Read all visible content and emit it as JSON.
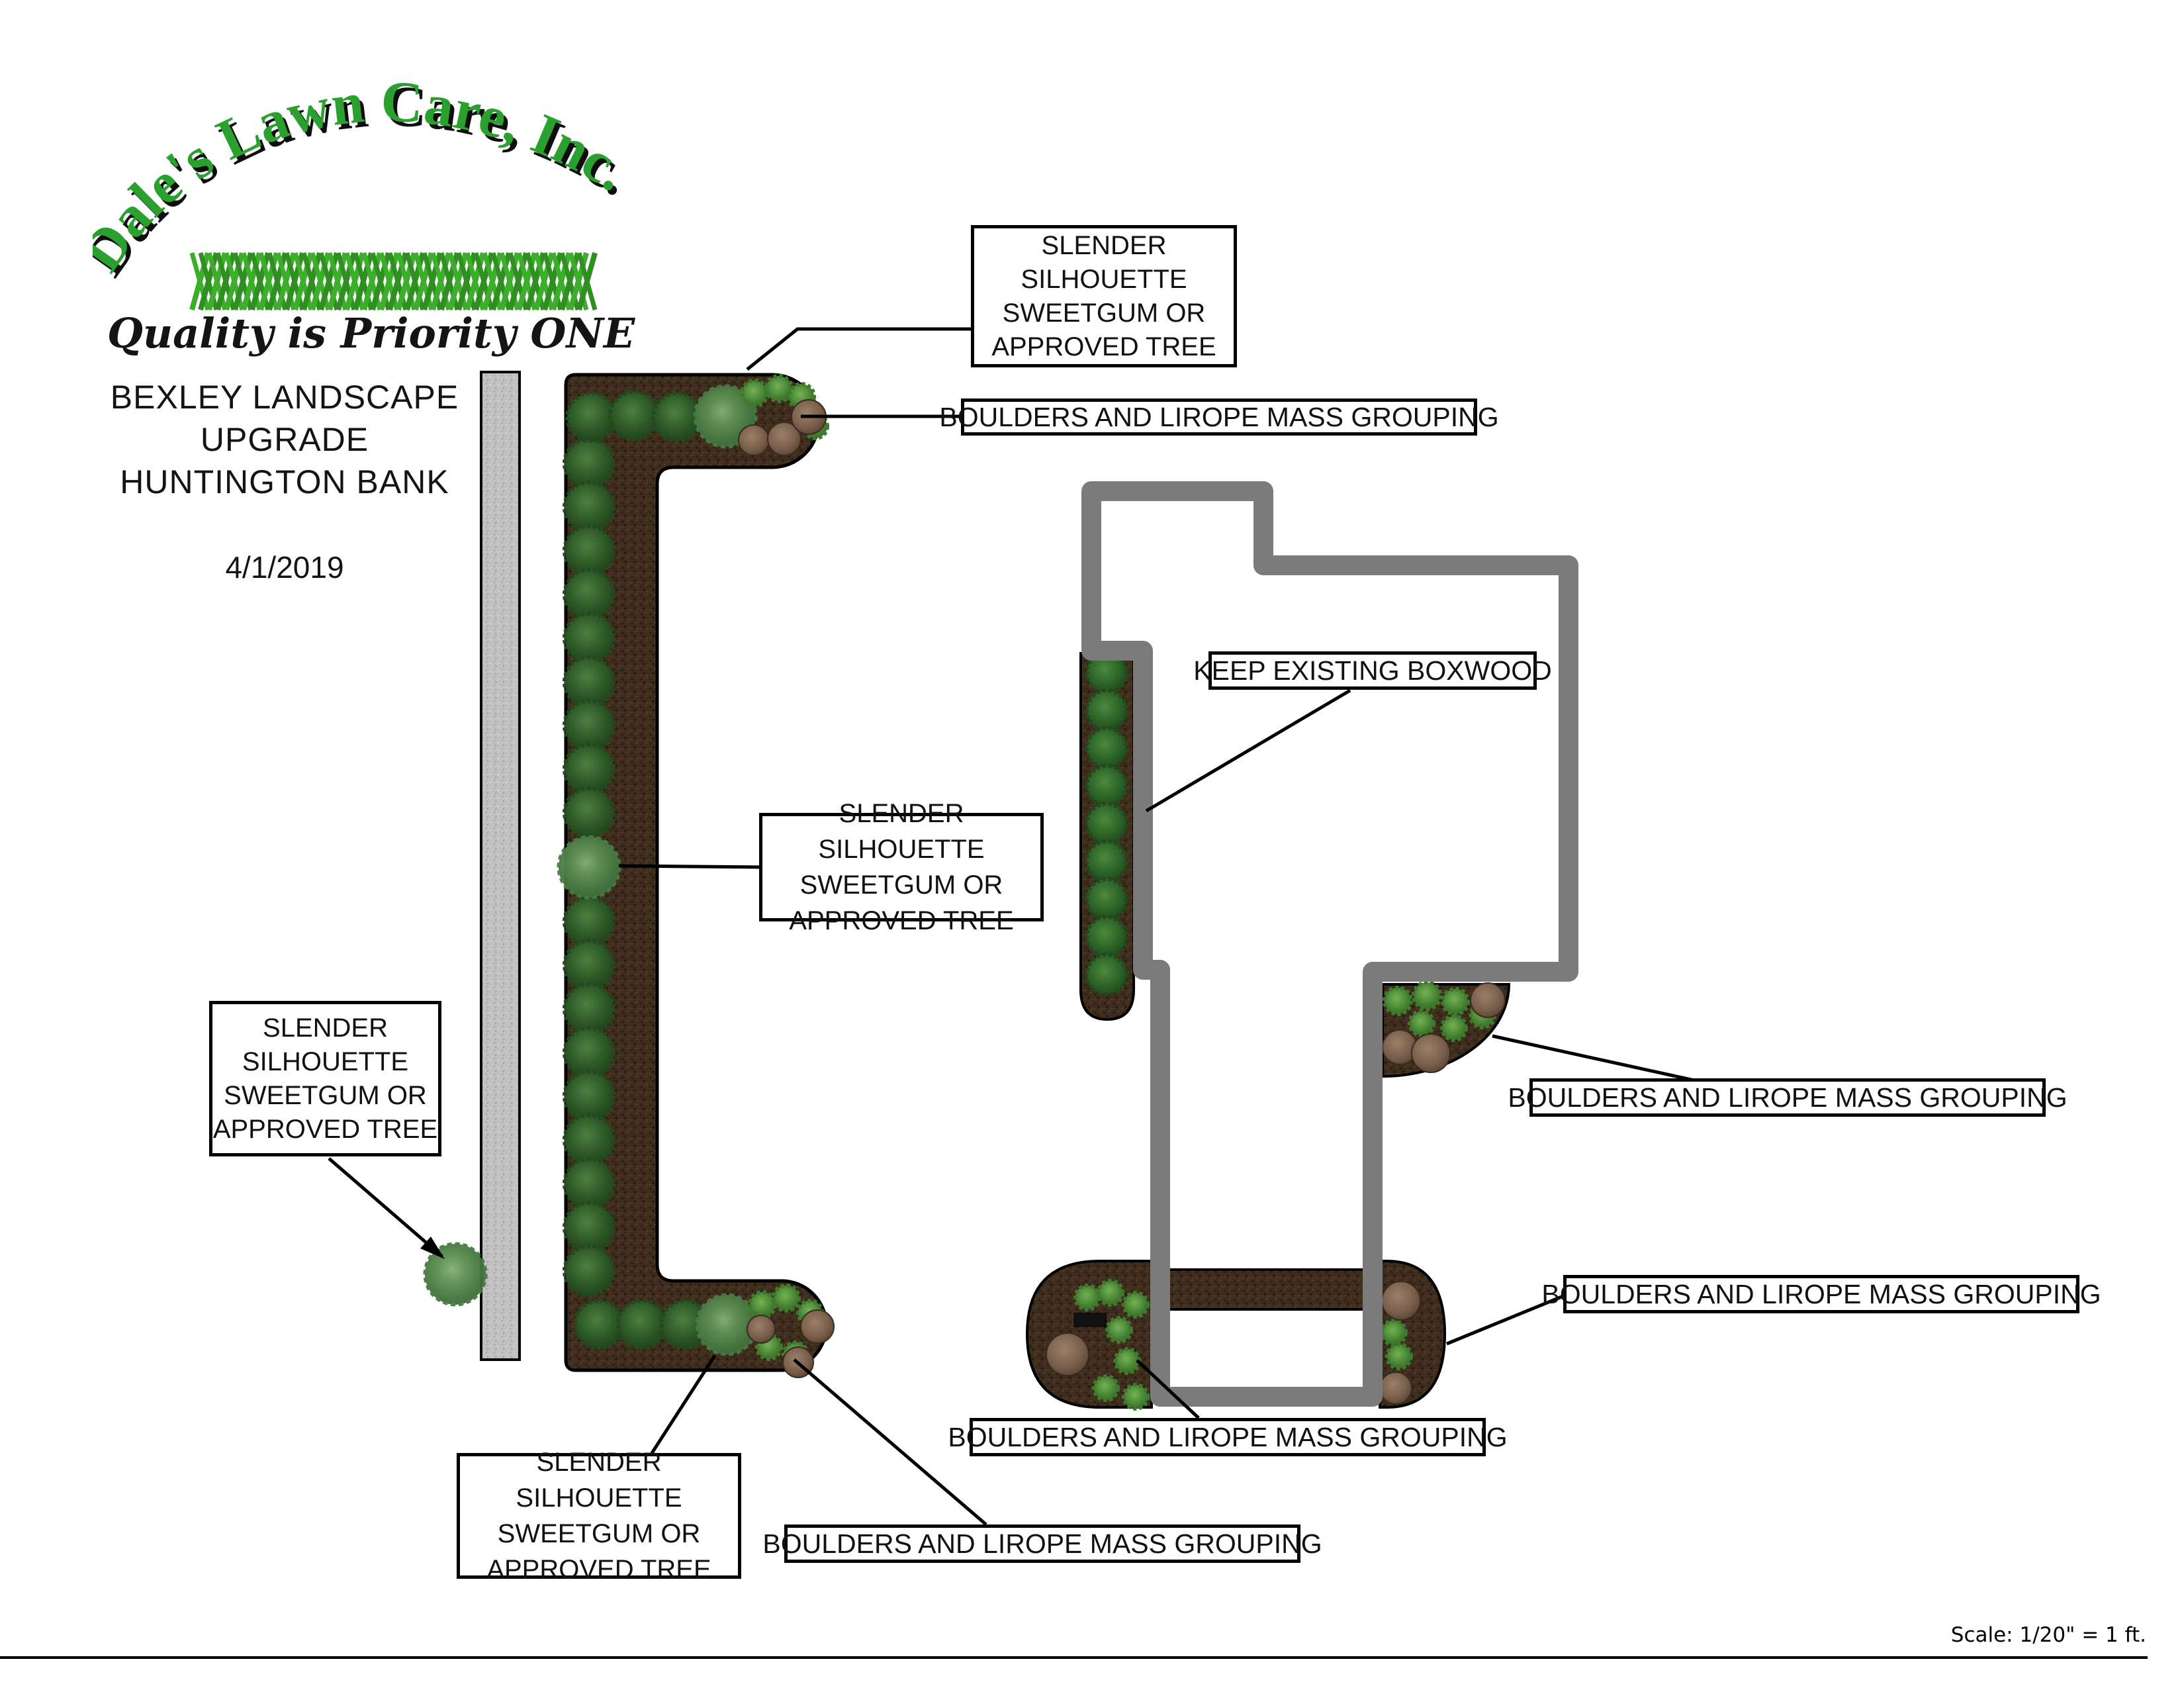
{
  "logo": {
    "brand": "Dale's Lawn Care, Inc.",
    "tagline": "Quality is Priority ONE"
  },
  "title": {
    "line1": "BEXLEY LANDSCAPE",
    "line2": "UPGRADE",
    "line3": "HUNTINGTON BANK",
    "date": "4/1/2019"
  },
  "callouts": {
    "slender_top": "SLENDER\nSILHOUETTE\nSWEETGUM OR\nAPPROVED TREE",
    "boulders_top": "BOULDERS AND LIROPE MASS GROUPING",
    "keep_boxwood": "KEEP EXISTING BOXWOOD",
    "slender_mid": "SLENDER SILHOUETTE\nSWEETGUM OR\nAPPROVED TREE",
    "slender_left": "SLENDER\nSILHOUETTE\nSWEETGUM OR\nAPPROVED TREE",
    "boulders_right_upper": "BOULDERS AND LIROPE MASS GROUPING",
    "boulders_right_lower": "BOULDERS AND LIROPE MASS GROUPING",
    "boulders_bottom_mid": "BOULDERS AND LIROPE MASS GROUPING",
    "slender_bottom": "SLENDER SILHOUETTE\nSWEETGUM OR\nAPPROVED TREE",
    "boulders_bottom_left": "BOULDERS AND LIROPE MASS GROUPING"
  },
  "scale_note": "Scale: 1/20\" = 1 ft.",
  "colors": {
    "mulch": "#3e2d1d",
    "mulch_dark": "#2c1f12",
    "mulch_light": "#4e3a26",
    "concrete": "#c0c0c0",
    "building_outline": "#7b7b7b",
    "leader_line": "#000000",
    "shrub_dark": "#2f5b28",
    "tree_green": "#5f9055",
    "spiky_green": "#4a8836",
    "boxwood_green": "#2d6327",
    "boulder_brown": "#7a604c",
    "logo_green": "#2aa12e"
  },
  "symbols": {
    "dark-shrub-icon": "dark green circle - evergreen shrub",
    "tree-icon": "light mottled green circle - sweetgum tree",
    "spiky-shrub-icon": "small jagged green circle - lirope",
    "boulder-icon": "brown rounded stone",
    "boxwood-icon": "medium green circle - existing boxwood",
    "sidewalk-icon": "gray concrete strip",
    "building-icon": "thick gray wall outline"
  }
}
